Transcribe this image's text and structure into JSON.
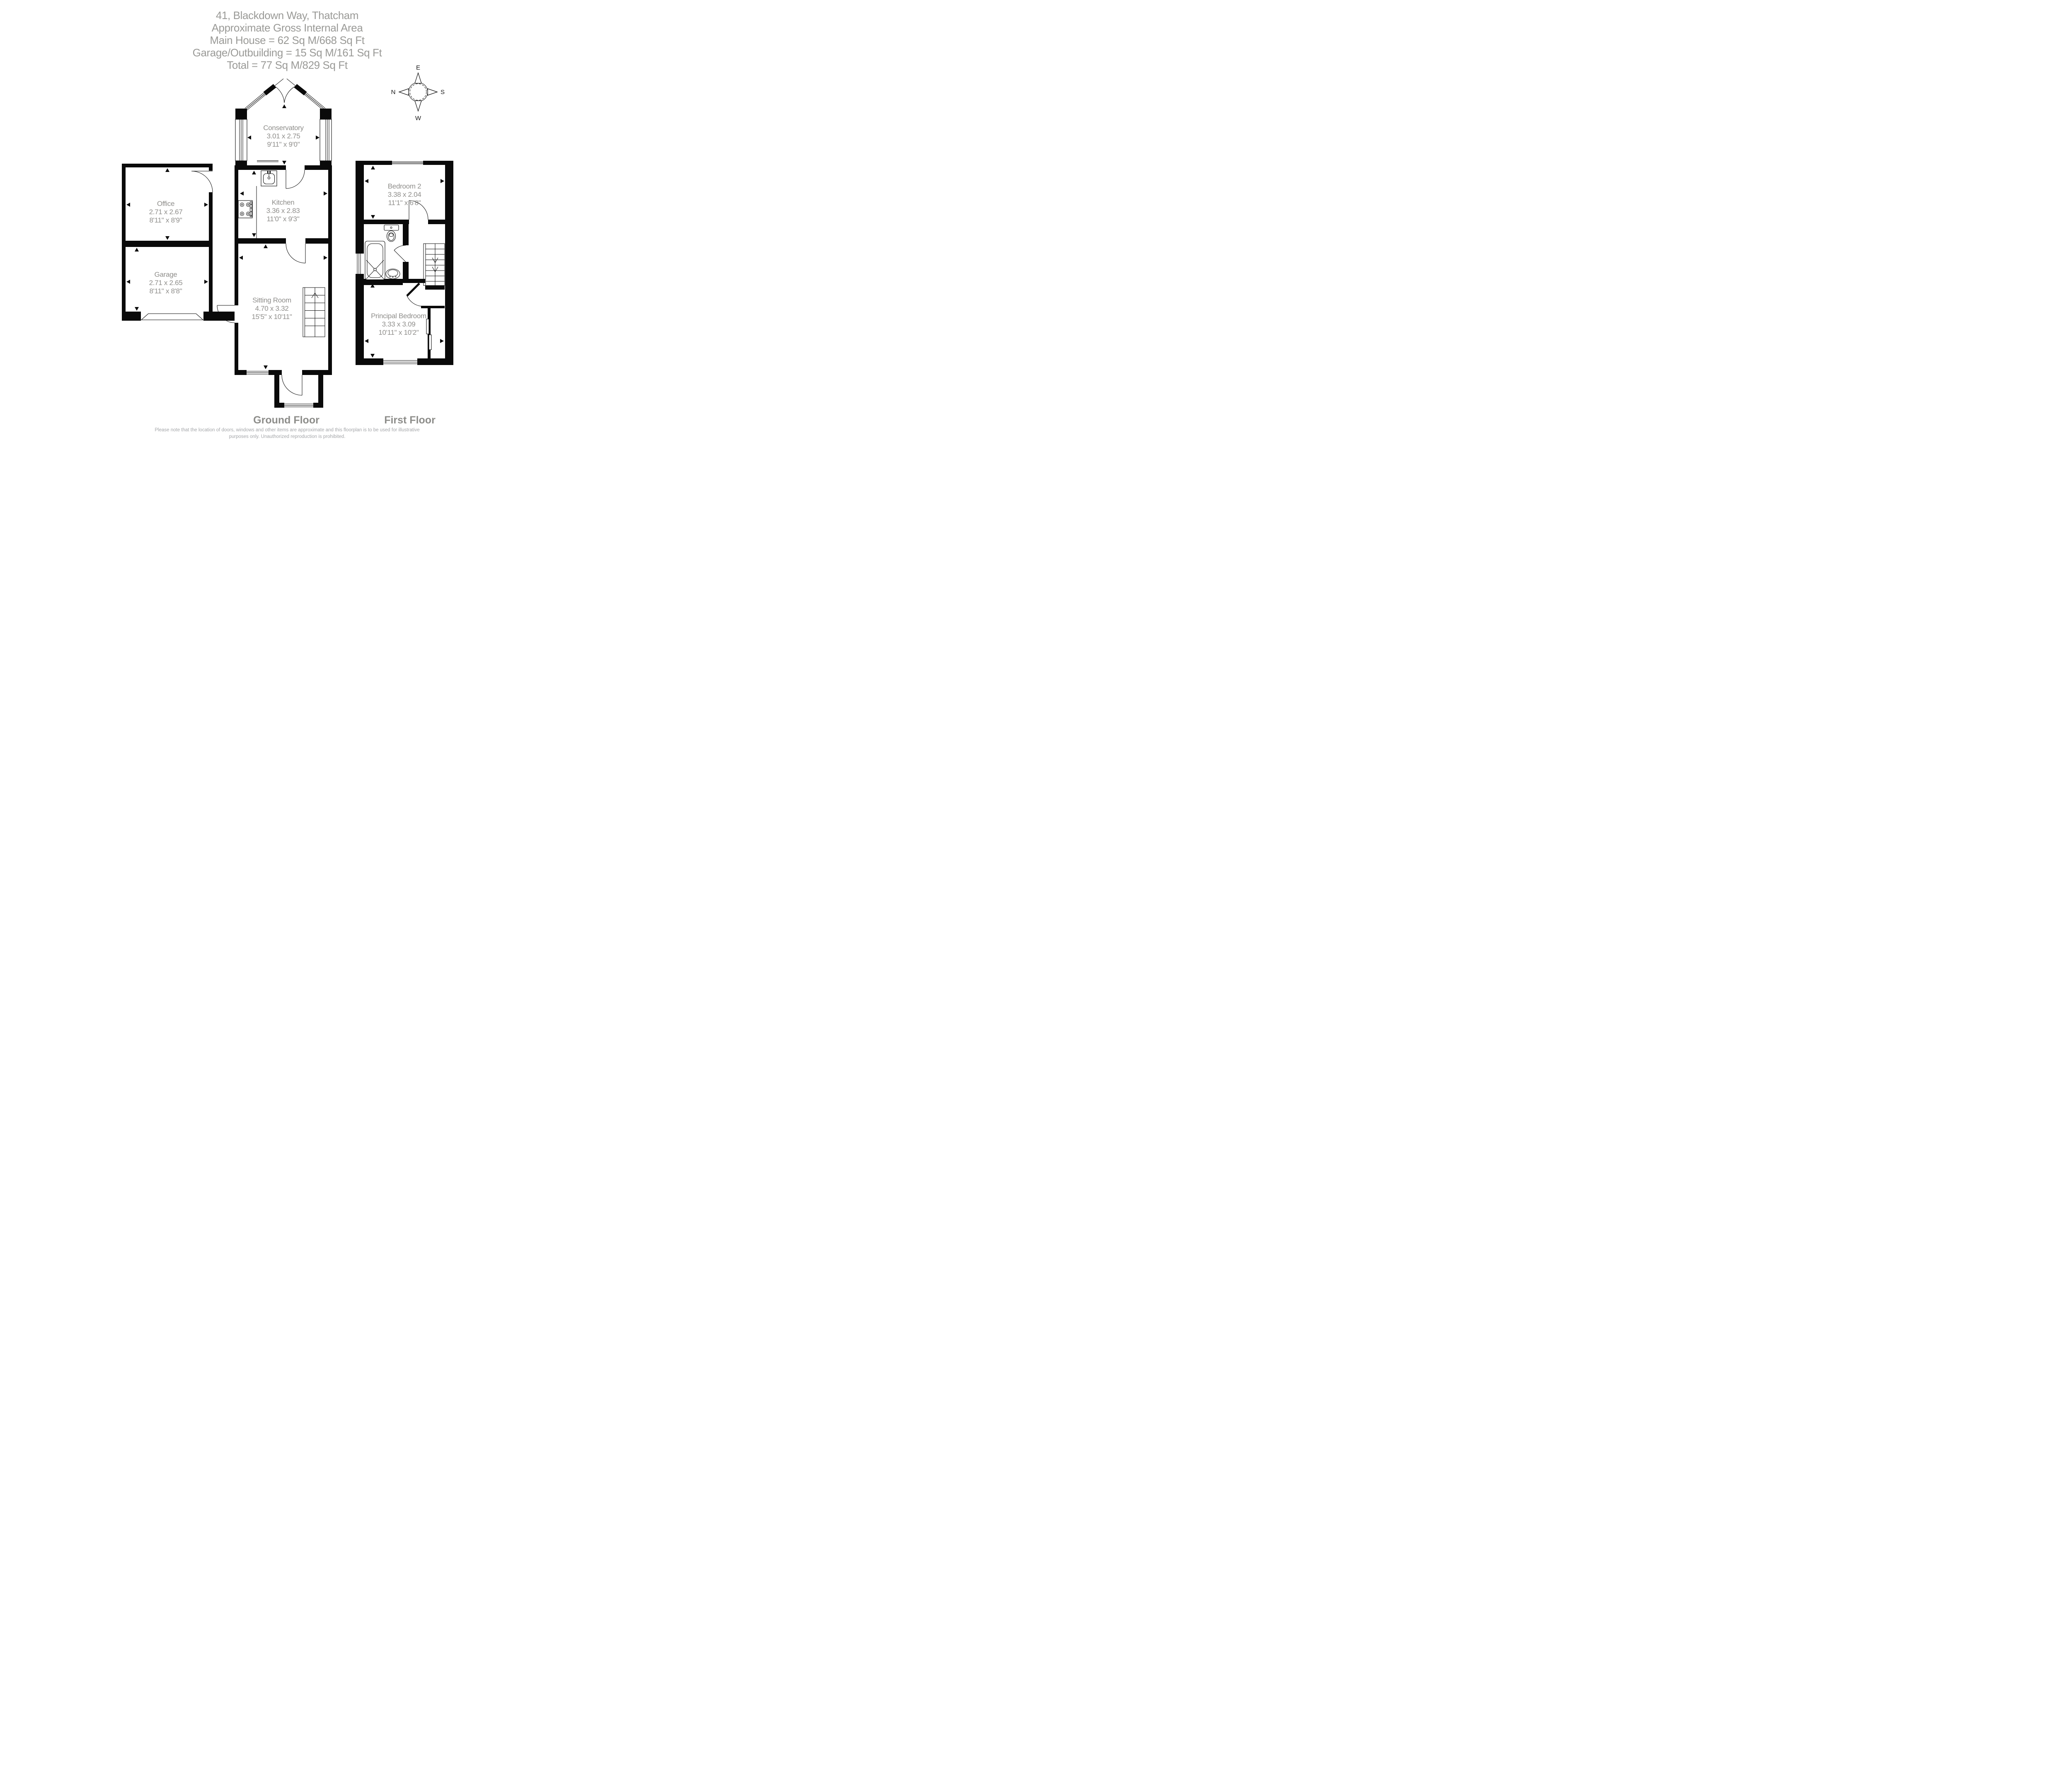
{
  "title": {
    "lines": [
      "41, Blackdown Way, Thatcham",
      "Approximate Gross Internal Area",
      "Main House = 62 Sq M/668 Sq Ft",
      "Garage/Outbuilding = 15 Sq M/161 Sq Ft",
      "Total = 77 Sq M/829 Sq Ft"
    ]
  },
  "compass": {
    "top": "E",
    "left": "N",
    "right": "S",
    "bottom": "W"
  },
  "ground_floor": {
    "label": "Ground Floor",
    "rooms": {
      "conservatory": {
        "name": "Conservatory",
        "metric": "3.01 x 2.75",
        "imperial": "9'11\" x 9'0\""
      },
      "kitchen": {
        "name": "Kitchen",
        "metric": "3.36 x 2.83",
        "imperial": "11'0\" x 9'3\""
      },
      "sitting_room": {
        "name": "Sitting Room",
        "metric": "4.70 x 3.32",
        "imperial": "15'5\" x 10'11\""
      },
      "office": {
        "name": "Office",
        "metric": "2.71 x 2.67",
        "imperial": "8'11\" x 8'9\""
      },
      "garage": {
        "name": "Garage",
        "metric": "2.71 x 2.65",
        "imperial": "8'11\" x 8'8\""
      }
    }
  },
  "first_floor": {
    "label": "First Floor",
    "rooms": {
      "bedroom2": {
        "name": "Bedroom 2",
        "metric": "3.38 x 2.04",
        "imperial": "11'1\" x 6'8\""
      },
      "principal_bedroom": {
        "name": "Principal Bedroom",
        "metric": "3.33 x 3.09",
        "imperial": "10'11\" x 10'2\""
      }
    }
  },
  "footer": {
    "lines": [
      "Please note that the location of doors, windows and other items are approximate and this floorplan is to be used for illustrative",
      "purposes only. Unauthorized reproduction is prohibited."
    ]
  },
  "colors": {
    "wall": "#0a0a0a",
    "room_label": "#8f8e8b",
    "title": "#9a9a97",
    "floor_label": "#8d8d8a",
    "footer": "#a4a6a9"
  }
}
